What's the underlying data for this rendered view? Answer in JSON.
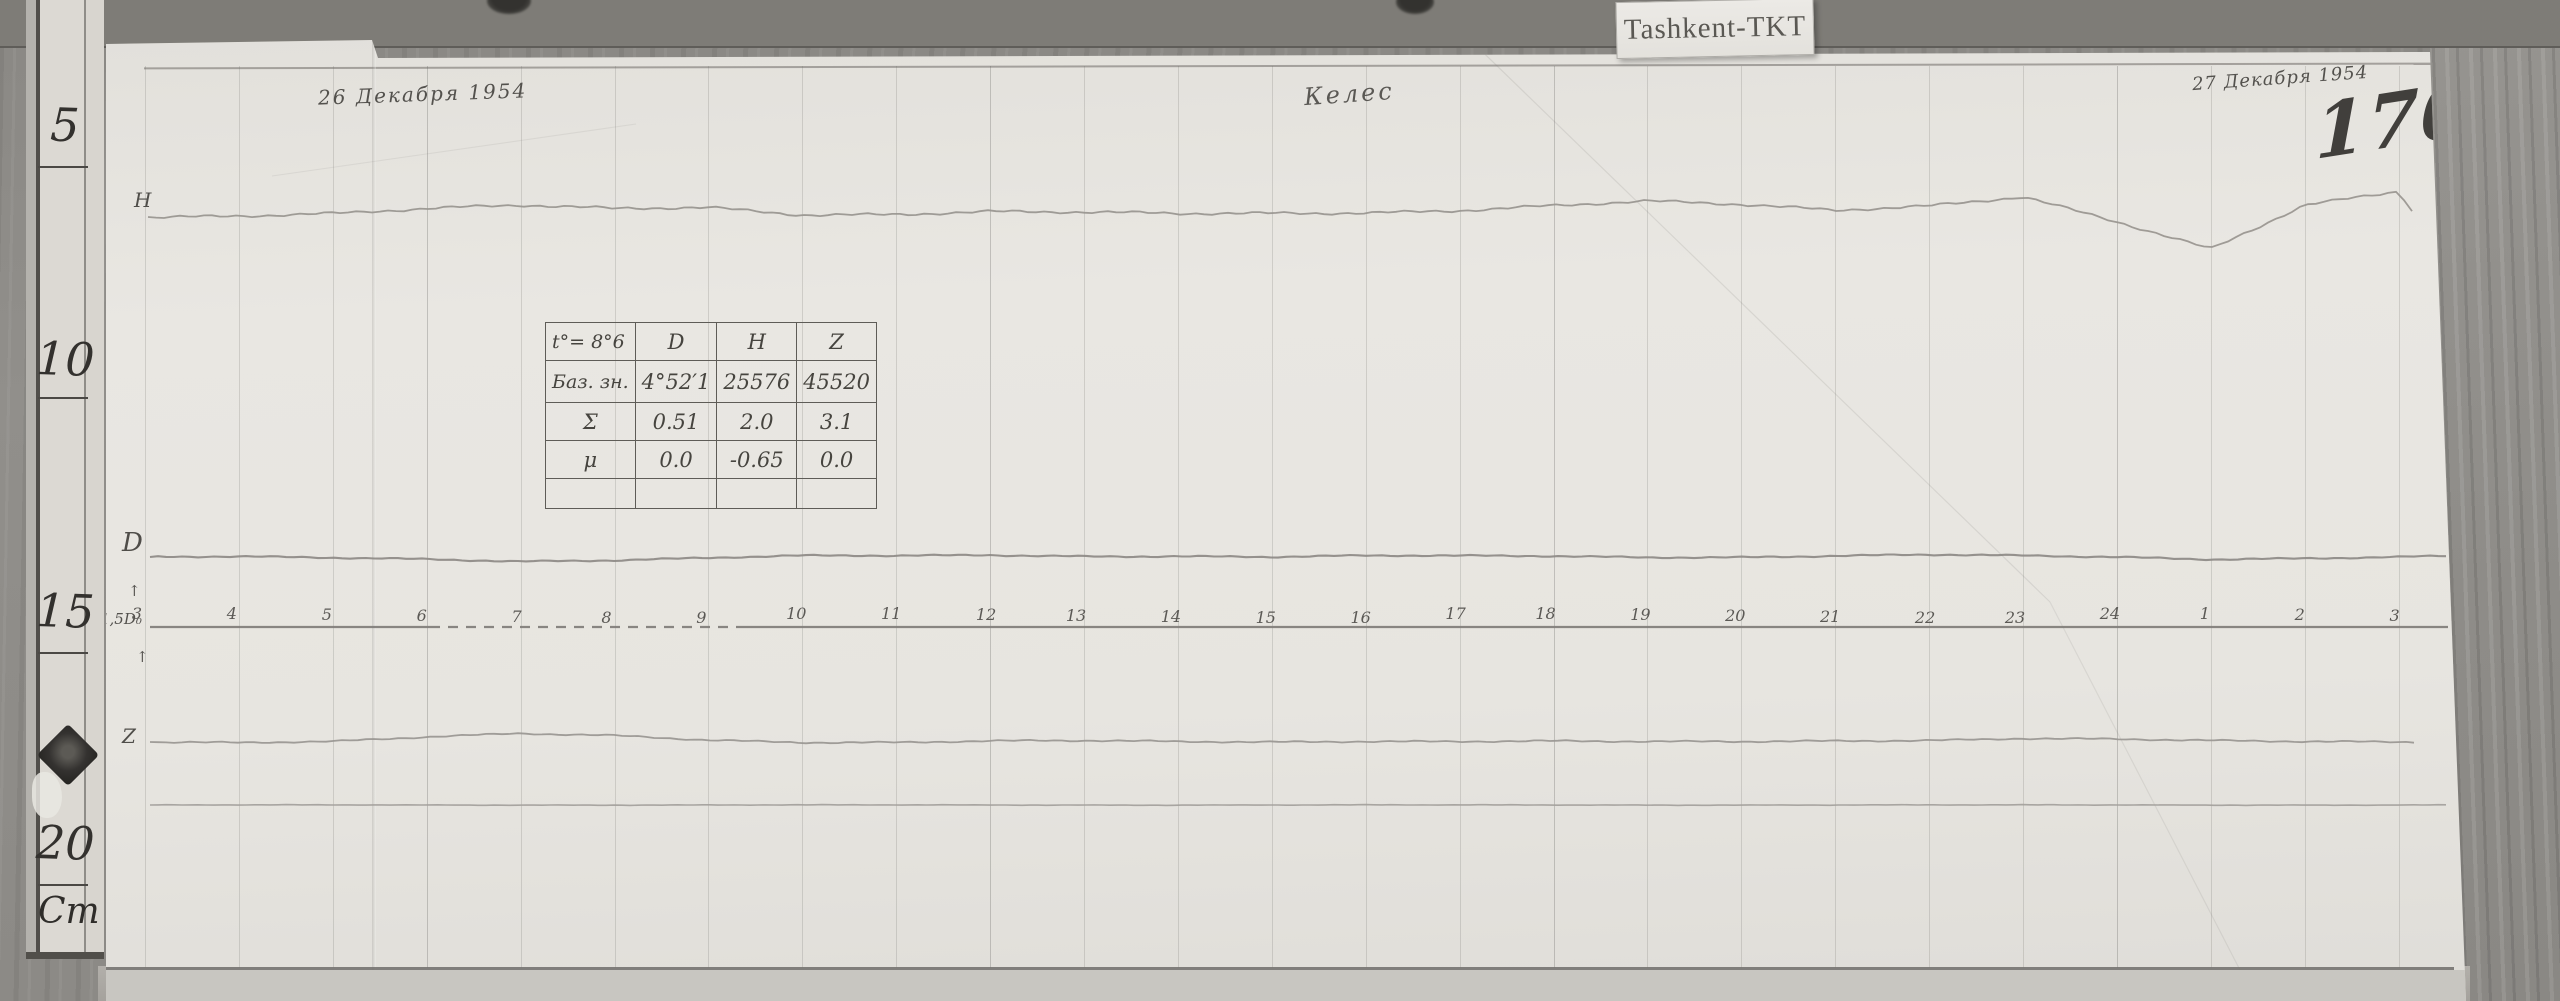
{
  "top_labels": {
    "date_left": "26 Декабря 1954",
    "site": "Келес",
    "date_right": "27 Декабря 1954",
    "sheet_number": "170",
    "station_tag": "Tashkent-TKT"
  },
  "ruler": {
    "marks": [
      "5",
      "10",
      "15",
      "20"
    ],
    "unit": "Cm"
  },
  "trace_labels": {
    "h": "H",
    "d": "D",
    "z": "Z",
    "baseline_note": "1,5D₀",
    "arrow_up": "↑"
  },
  "calibration_table": {
    "header": [
      "t°= 8°6",
      "D",
      "H",
      "Z"
    ],
    "rows": [
      {
        "label": "Баз. зн.",
        "d": "4°52′1",
        "h": "25576",
        "z": "45520"
      },
      {
        "label": "Σ",
        "d": "0.51",
        "h": "2.0",
        "z": "3.1"
      },
      {
        "label": "μ",
        "d": "0.0",
        "h": "-0.65",
        "z": "0.0"
      },
      {
        "label": "",
        "d": "",
        "h": "",
        "z": ""
      }
    ]
  },
  "chart_data": {
    "type": "line",
    "title": "Magnetogram, Tashkent-TKT (Келес), 26–27 December 1954, sheet 170",
    "x_hour_labels": [
      "3",
      "4",
      "5",
      "6",
      "7",
      "8",
      "9",
      "10",
      "11",
      "12",
      "13",
      "14",
      "15",
      "16",
      "17",
      "18",
      "19",
      "20",
      "21",
      "22",
      "23",
      "24",
      "1",
      "2",
      "3"
    ],
    "axis": {
      "x_start_px": 145,
      "x_step_px": 93.9,
      "baseline_y_px": 627,
      "baseline_dashed_segment_x_px": [
        430,
        736
      ],
      "grid": "vertical line every hour",
      "legend_position": "trace letters at left margin"
    },
    "series": [
      {
        "name": "H",
        "start": [
          148,
          217
        ],
        "y_at_hours": [
          217,
          215,
          213,
          209,
          206,
          209,
          207,
          214,
          214,
          212,
          213,
          214,
          213,
          212,
          210,
          206,
          202,
          205,
          210,
          205,
          196,
          222,
          250,
          206,
          191
        ],
        "end": [
          2418,
          218
        ]
      },
      {
        "name": "D",
        "start": [
          150,
          557
        ],
        "y_at_hours": [
          557,
          557,
          558,
          559,
          561,
          560,
          558,
          556,
          556,
          555,
          556,
          556,
          557,
          556,
          556,
          556,
          557,
          557,
          556,
          555,
          556,
          557,
          559,
          558,
          557
        ],
        "end": [
          2450,
          556
        ]
      },
      {
        "name": "Z",
        "start": [
          150,
          742
        ],
        "y_at_hours": [
          742,
          742,
          741,
          737,
          734,
          736,
          740,
          742,
          742,
          741,
          741,
          742,
          742,
          741,
          741,
          741,
          742,
          742,
          741,
          740,
          738,
          739,
          741,
          742,
          742
        ],
        "end": [
          2415,
          742
        ]
      },
      {
        "name": "temperature-baseline",
        "start": [
          150,
          805
        ],
        "y_at_hours": [
          805,
          805,
          805,
          805,
          805,
          805,
          805,
          805,
          805,
          805,
          805,
          805,
          805,
          805,
          805,
          805,
          805,
          805,
          805,
          805,
          805,
          805,
          805,
          805,
          805
        ],
        "end": [
          2448,
          805
        ]
      }
    ],
    "ylabel": "photographic trace deflection (vertical position, px)"
  }
}
